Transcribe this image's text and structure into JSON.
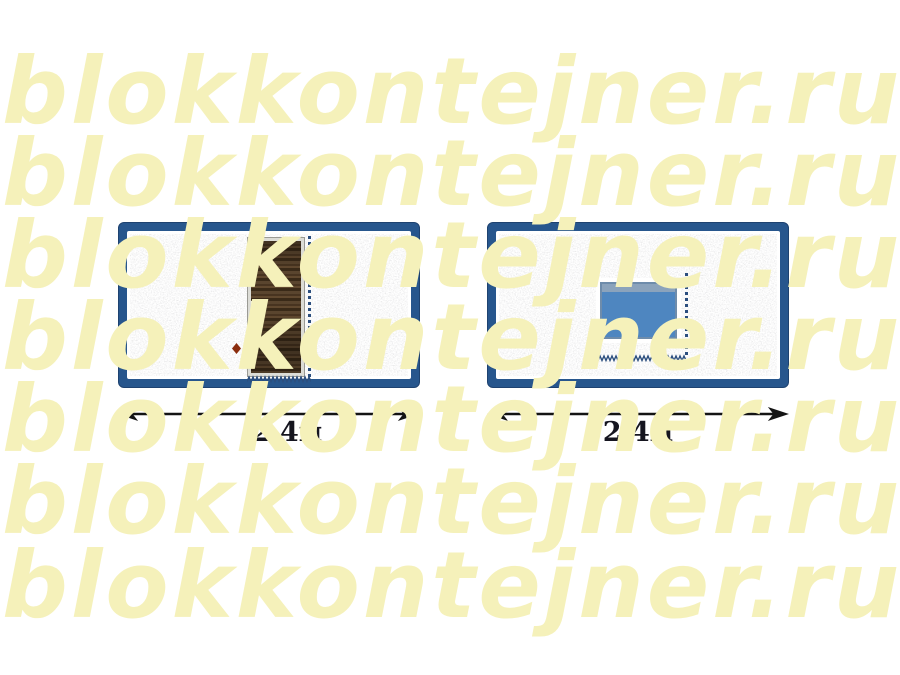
{
  "watermark": {
    "text": "blokkontejner.ru",
    "color": "#F5F1BA",
    "row_count": 7
  },
  "views": [
    {
      "name": "container-front-with-door",
      "feature": "door",
      "dimension_label": "2,4м"
    },
    {
      "name": "container-front-with-window",
      "feature": "window",
      "dimension_label": "2,4м"
    }
  ],
  "colors": {
    "container_frame_blue": "#27568D",
    "door_wood_brown": "#4C3823",
    "door_frame_gray": "#DCDCD6",
    "window_glass_blue": "#4E86C0",
    "window_sash_gray_blue": "#8BA3BC",
    "stitch_blue": "#2B4E7E",
    "door_knob_red": "#8B2D0E",
    "arrow_black": "#141414",
    "wall_texture_gray": "#D9D9DA"
  }
}
